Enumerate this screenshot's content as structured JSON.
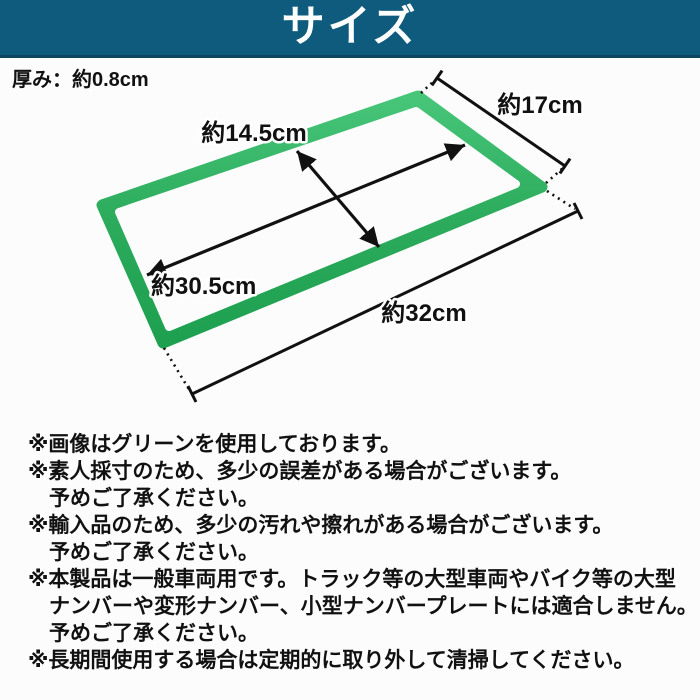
{
  "banner": {
    "title": "サイズ",
    "bg_color": "#0f5b7e",
    "text_color": "#ffffff"
  },
  "diagram": {
    "thickness_label": "厚み：約0.8cm",
    "frame_color": "#2cab5c",
    "line_color": "#111111",
    "labels": {
      "side_17": "約17cm",
      "inner_height_14_5": "約14.5cm",
      "inner_width_30_5": "約30.5cm",
      "outer_width_32": "約32cm"
    }
  },
  "notes": [
    "※画像はグリーンを使用しております。",
    "※素人採寸のため、多少の誤差がある場合がございます。",
    "予めご了承ください。",
    "※輸入品のため、多少の汚れや擦れがある場合がございます。",
    "予めご了承ください。",
    "※本製品は一般車両用です。トラック等の大型車両やバイク等の大型",
    "ナンバーや変形ナンバー、小型ナンバープレートには適合しません。",
    "予めご了承ください。",
    "※長期間使用する場合は定期的に取り外して清掃してください。"
  ]
}
